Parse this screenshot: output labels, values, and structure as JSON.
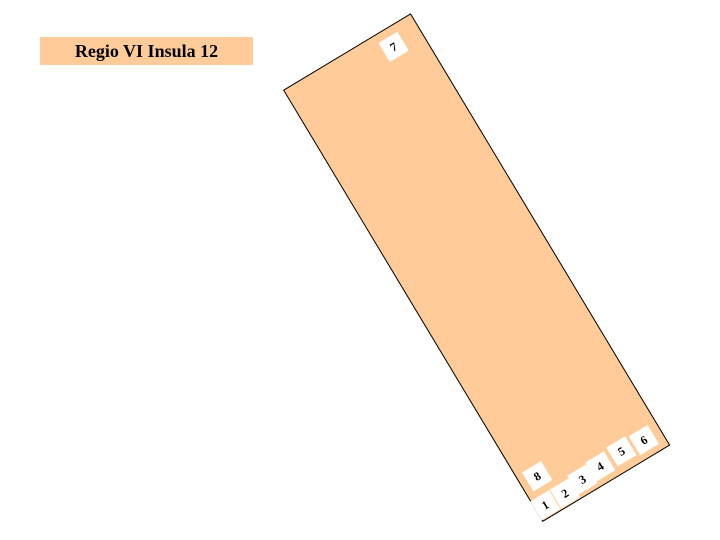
{
  "page": {
    "background": "#ffffff"
  },
  "header": {
    "title": "Regio VI Insula 12",
    "background": "#ffcc99",
    "text_color": "#000000"
  },
  "map": {
    "insula": {
      "fill": "#ffcc99",
      "border": "#000000",
      "label_background": "#ffffff",
      "label_text_color": "#000000",
      "entrance_labels": [
        {
          "label": "7",
          "x": 105,
          "y": 8
        },
        {
          "label": "8",
          "x": 7,
          "y": 450
        },
        {
          "label": "1",
          "x": -1,
          "y": 479
        },
        {
          "label": "2",
          "x": 22,
          "y": 479
        },
        {
          "label": "3",
          "x": 44,
          "y": 476
        },
        {
          "label": "4",
          "x": 66,
          "y": 474
        },
        {
          "label": "5",
          "x": 92,
          "y": 472
        },
        {
          "label": "6",
          "x": 117,
          "y": 474
        }
      ]
    }
  }
}
